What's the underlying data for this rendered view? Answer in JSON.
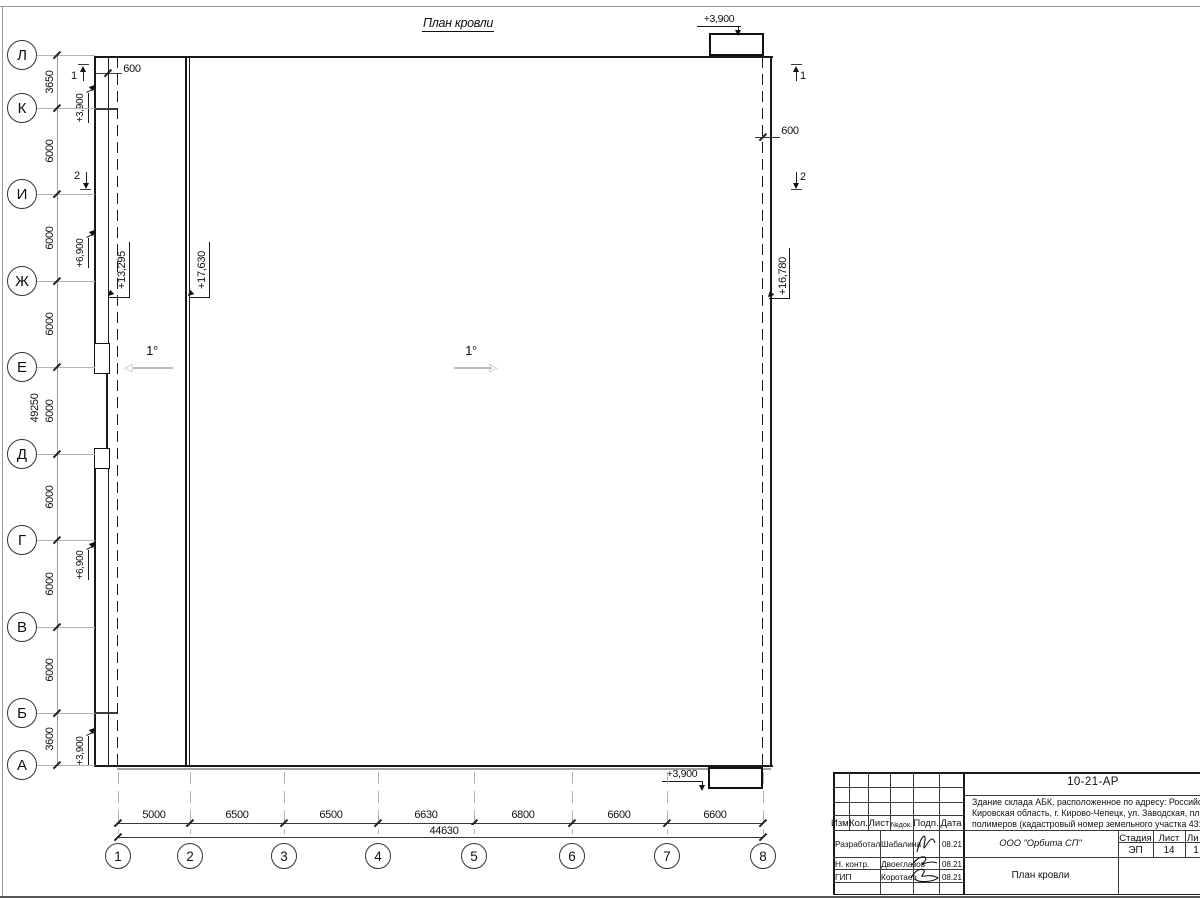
{
  "sheet_title": "План кровли",
  "axes": {
    "left": [
      "Л",
      "К",
      "И",
      "Ж",
      "Е",
      "Д",
      "Г",
      "В",
      "Б",
      "А"
    ],
    "bottom": [
      "1",
      "2",
      "3",
      "4",
      "5",
      "6",
      "7",
      "8"
    ]
  },
  "dimensions": {
    "left_chain": [
      "3650",
      "6000",
      "6000",
      "6000",
      "6000",
      "6000",
      "6000",
      "6000",
      "3600"
    ],
    "left_total": "49250",
    "bottom_chain": [
      "5000",
      "6500",
      "6500",
      "6630",
      "6800",
      "6600",
      "6600"
    ],
    "bottom_total": "44630",
    "parapet_top_left": "600",
    "parapet_right": "600"
  },
  "elevations": {
    "low_roof": "+13,295",
    "main_roof_left": "+17,630",
    "main_roof_right": "+16,780",
    "canopy_top_right": "+3,900",
    "canopy_bottom_right": "+3,900",
    "left_upper_canopy": "+3,900",
    "left_lower_canopy": "+3,900",
    "left_upper_annex": "+6,900",
    "left_lower_annex": "+6,900"
  },
  "slopes": {
    "left": "1°",
    "right": "1°"
  },
  "sections": {
    "one": "1",
    "two": "2"
  },
  "title_block": {
    "doc_number": "10-21-АР",
    "description_line1": "Здание склада АБК, расположенное по адресу: Российская Феде",
    "description_line2": "Кировская область, г. Кирово-Чепецк, ул. Заводская, площадка з",
    "description_line3": "полимеров (кадастровый номер земельного участка 43:42:00000",
    "columns": [
      "Изм.",
      "Кол.",
      "Лист",
      "№док.",
      "Подп.",
      "Дата"
    ],
    "rows": [
      {
        "role": "Разработал",
        "name": "Шабалина",
        "date": "08.21"
      },
      {
        "role": "Н. контр.",
        "name": "Двоеглазов",
        "date": "08.21"
      },
      {
        "role": "ГИП",
        "name": "Коротаев",
        "date": "08.21"
      }
    ],
    "company": "ООО \"Орбита СП\"",
    "drawing_title": "План кровли",
    "stage": {
      "labels": [
        "Стадия",
        "Лист",
        "Ли"
      ],
      "values": [
        "ЭП",
        "14",
        "1"
      ]
    }
  }
}
